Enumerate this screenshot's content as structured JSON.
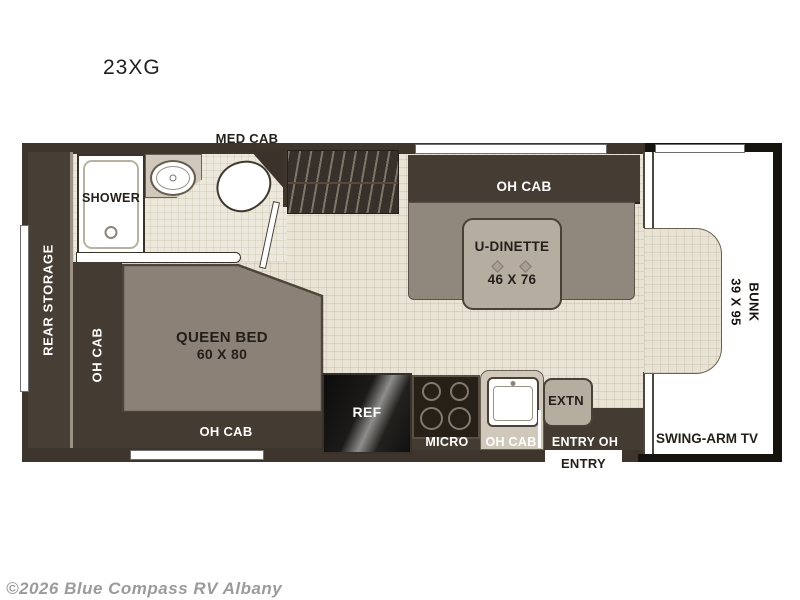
{
  "page": {
    "title": "23XG",
    "watermark": "©2026 Blue Compass RV Albany"
  },
  "floorplan": {
    "bathroom": {
      "med_cab": "MED CAB",
      "shower": "SHOWER"
    },
    "bedroom": {
      "rear_storage": "REAR STORAGE",
      "oh_cab_side": "OH CAB",
      "bed_line1": "QUEEN BED",
      "bed_line2": "60 X 80",
      "oh_cab_foot": "OH CAB"
    },
    "dinette": {
      "oh_cab": "OH CAB",
      "line1": "U-DINETTE",
      "line2": "46 X 76"
    },
    "kitchen": {
      "ref": "REF",
      "micro": "MICRO",
      "oh_cab": "OH CAB",
      "extn": "EXTN"
    },
    "entry": {
      "entry_oh": "ENTRY OH",
      "entry": "ENTRY"
    },
    "cab": {
      "bunk_line1": "BUNK",
      "bunk_line2": "39 X 95",
      "tv": "SWING-ARM TV"
    }
  },
  "colors": {
    "wall": "#3e362d",
    "floor": "#e8e3d4",
    "bed": "#8b8177",
    "bench": "#90877d",
    "table": "#b6ada1",
    "cab_outline": "#17130f"
  }
}
